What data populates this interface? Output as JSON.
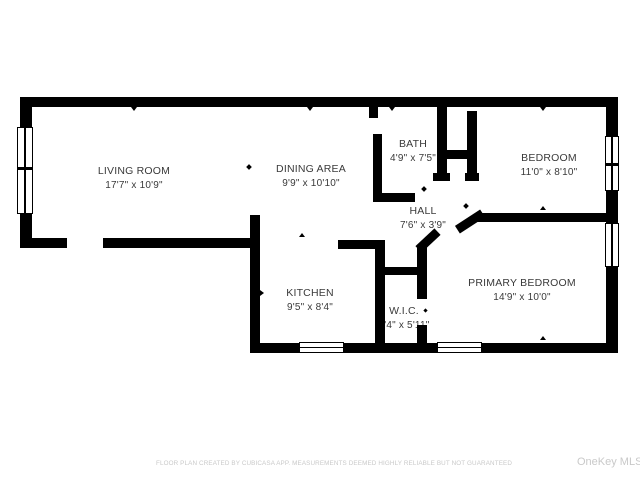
{
  "colors": {
    "wall": "#000000",
    "background": "#ffffff",
    "room_text": "#3a3a3a",
    "muted_text": "#c9c9c9"
  },
  "rooms": {
    "living": {
      "name": "LIVING ROOM",
      "dims": "17'7\" x 10'9\""
    },
    "dining": {
      "name": "DINING AREA",
      "dims": "9'9\" x 10'10\""
    },
    "bath": {
      "name": "BATH",
      "dims": "4'9\" x 7'5\""
    },
    "bedroom": {
      "name": "BEDROOM",
      "dims": "11'0\" x 8'10\""
    },
    "hall": {
      "name": "HALL",
      "dims": "7'6\" x 3'9\""
    },
    "kitchen": {
      "name": "KITCHEN",
      "dims": "9'5\" x 8'4\""
    },
    "wic": {
      "name": "W.I.C.",
      "dims": "3'4\" x 5'11\""
    },
    "primary": {
      "name": "PRIMARY BEDROOM",
      "dims": "14'9\" x 10'0\""
    }
  },
  "footer": {
    "disclaimer": "FLOOR PLAN CREATED BY CUBICASA APP. MEASUREMENTS DEEMED HIGHLY RELIABLE BUT NOT GUARANTEED",
    "watermark": "OneKey MLS"
  }
}
